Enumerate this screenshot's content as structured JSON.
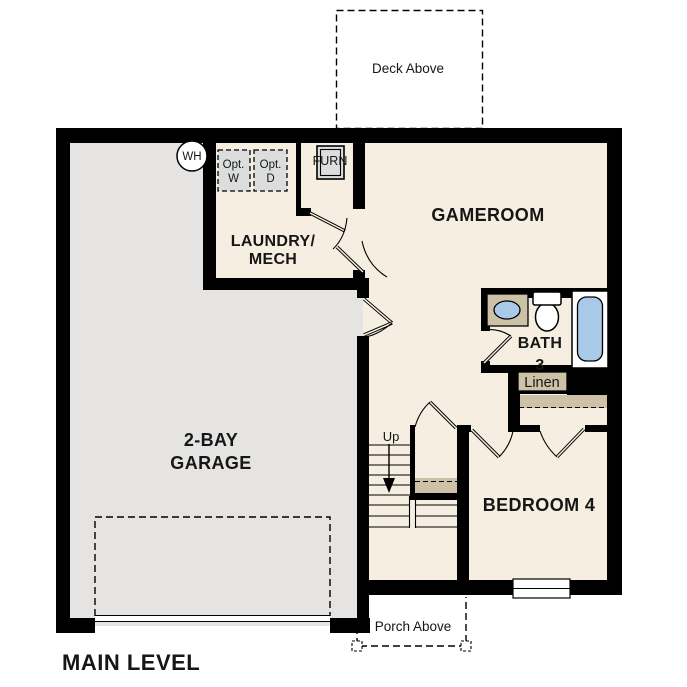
{
  "title": {
    "main_level": "MAIN LEVEL"
  },
  "colors": {
    "wall": "#000000",
    "room_fill": "#f5eee1",
    "garage_fill": "#e5e4e2",
    "casework_fill": "#cdc2a7",
    "fixture_blue": "#a9c9e9",
    "appliance_fill": "#dcdedd",
    "background": "#ffffff",
    "text": "#161616"
  },
  "rooms": {
    "gameroom": {
      "label": "GAMEROOM"
    },
    "laundry_mech": {
      "line1": "LAUNDRY/",
      "line2": "MECH"
    },
    "garage": {
      "line1": "2-BAY",
      "line2": "GARAGE"
    },
    "bath3": {
      "line1": "BATH",
      "line2": "3"
    },
    "bedroom4": {
      "label": "BEDROOM 4"
    },
    "linen": {
      "label": "Linen"
    }
  },
  "annotations": {
    "deck": "Deck Above",
    "porch": "Porch Above",
    "stairs_direction": "Up"
  },
  "fixtures": {
    "water_heater": "WH",
    "furnace": "FURN",
    "washer": {
      "line1": "Opt.",
      "line2": "W"
    },
    "dryer": {
      "line1": "Opt.",
      "line2": "D"
    }
  }
}
